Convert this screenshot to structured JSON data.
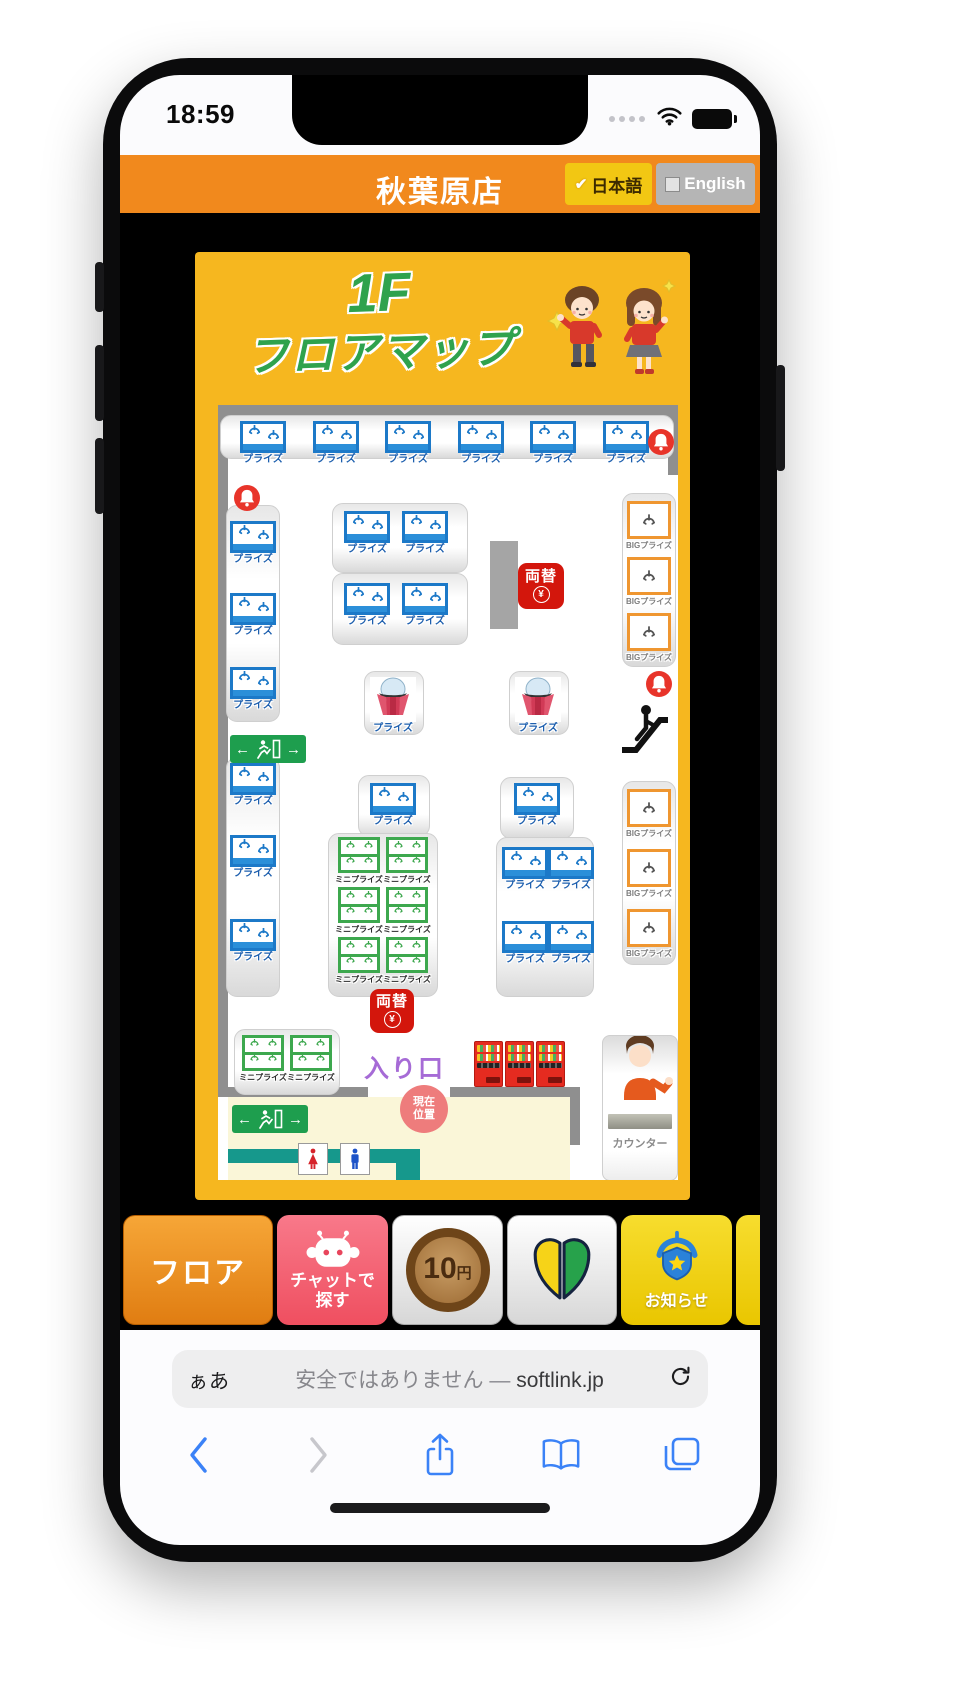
{
  "status_bar": {
    "time": "18:59"
  },
  "header": {
    "store_title": "秋葉原店",
    "japanese_check": "✔",
    "japanese_label": "日本語",
    "english_label": "English"
  },
  "map": {
    "floor_title_line1": "1F",
    "floor_title_line2": "フロアマップ",
    "labels": {
      "prize": "プライズ",
      "mini_prize": "ミニプライズ",
      "big_prize": "BIGプライズ",
      "exchange": "両替",
      "yen": "¥",
      "entrance": "入り口",
      "current_location_line1": "現在",
      "current_location_line2": "位置",
      "counter": "カウンター"
    },
    "machine_counts": {
      "prize_claw_machines": 22,
      "dome_prize_machines": 2,
      "mini_prize_machines": 8,
      "big_prize_machines": 6,
      "money_exchange_spots": 2,
      "vending_machines": 3,
      "alarm_bells": 3,
      "emergency_exit_signs": 2
    }
  },
  "toolbar": {
    "floor_label": "フロア",
    "chat_label_line1": "チャットで",
    "chat_label_line2": "探す",
    "coin_value": "10",
    "coin_unit": "円",
    "notice_label": "お知らせ"
  },
  "browser": {
    "reader_button": "ぁあ",
    "security_text": "安全ではありません",
    "separator": "—",
    "domain": "softlink.jp"
  },
  "colors": {
    "header_orange": "#f1891d",
    "map_panel_yellow": "#f6b71f",
    "title_green": "#2fa24d",
    "prize_blue": "#1c79c8",
    "mini_prize_green": "#3da84e",
    "big_prize_orange": "#ef9630",
    "exchange_red": "#d3160c",
    "entrance_purple": "#a66bd6",
    "current_location_pink": "#ee7c7c",
    "exit_sign_green": "#1e9e4e",
    "corridor_teal": "#16988c",
    "chat_button_pink": "#f4606c",
    "notice_button_yellow": "#f2cf00"
  }
}
